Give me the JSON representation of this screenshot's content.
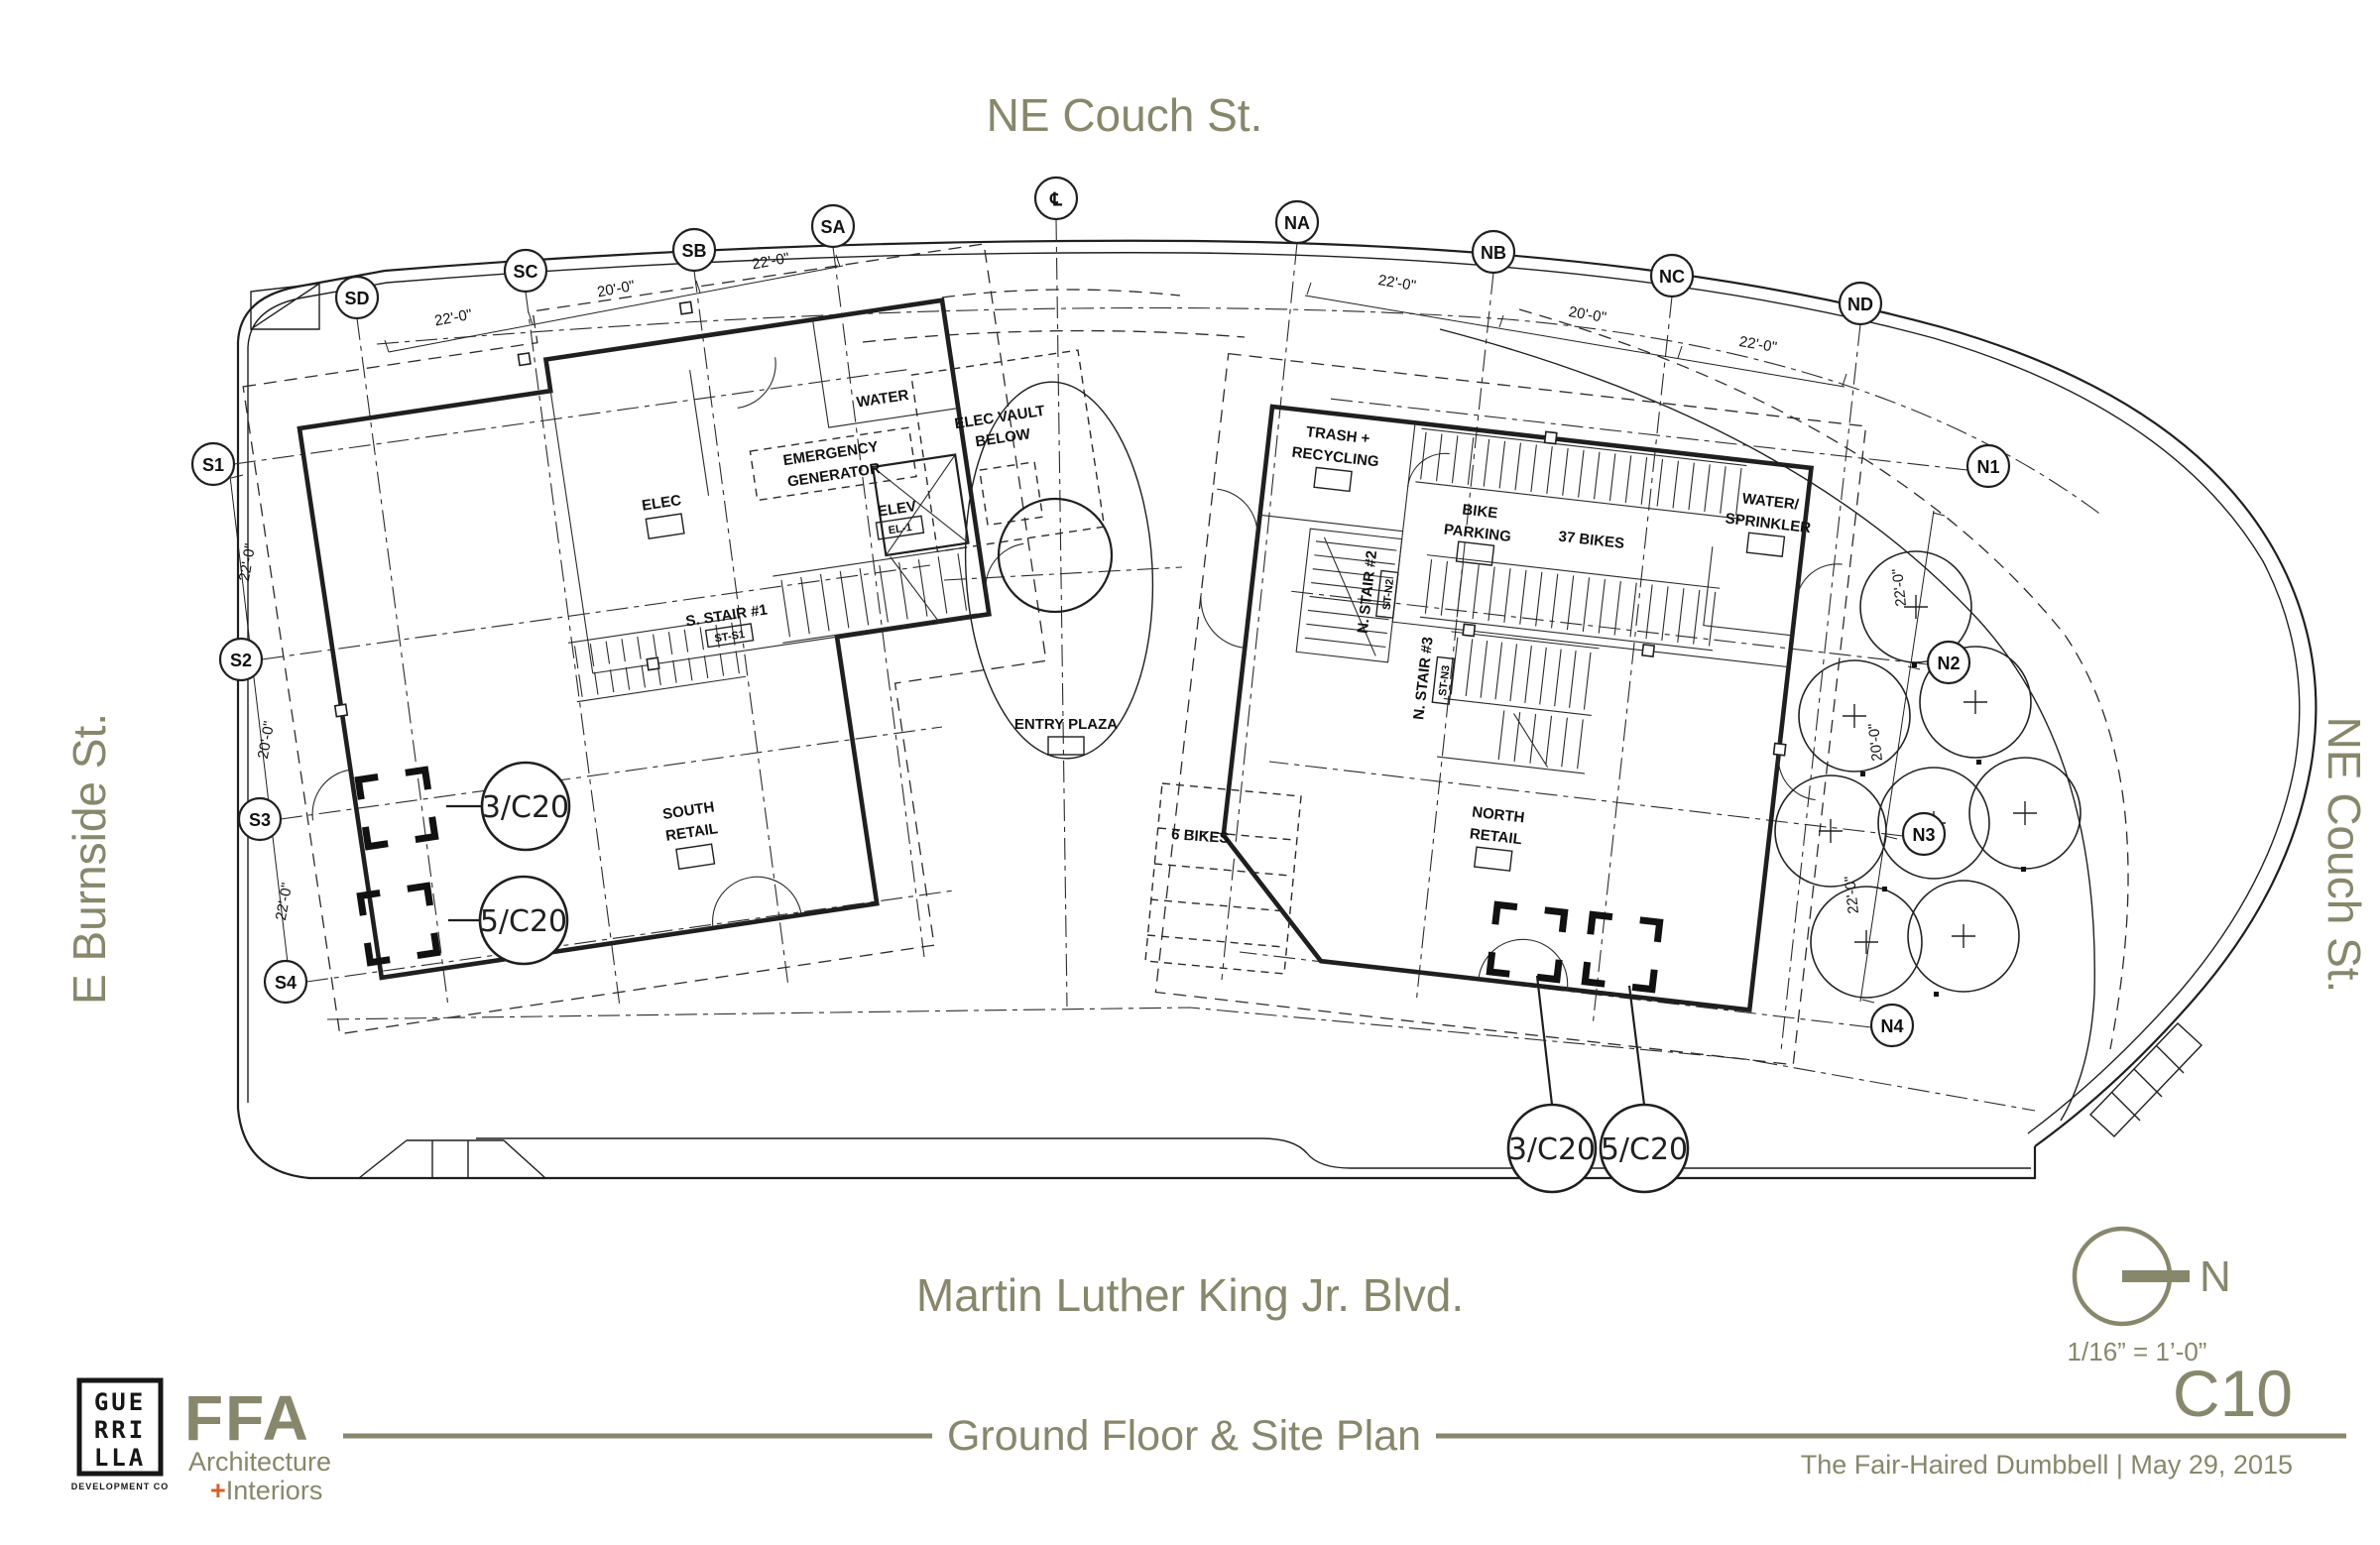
{
  "streets": {
    "top": "NE Couch St.",
    "bottom": "Martin Luther King Jr. Blvd.",
    "left": "E Burnside St.",
    "right": "NE Couch St."
  },
  "grid": {
    "top": [
      "SD",
      "SC",
      "SB",
      "SA",
      "℄",
      "NA",
      "NB",
      "NC",
      "ND"
    ],
    "left": [
      "S1",
      "S2",
      "S3",
      "S4"
    ],
    "right": [
      "N1",
      "N2",
      "N3",
      "N4"
    ]
  },
  "dims": {
    "top_south": [
      "22'-0\"",
      "20'-0\"",
      "22'-0\""
    ],
    "top_north": [
      "22'-0\"",
      "20'-0\"",
      "22'-0\""
    ],
    "west": [
      "22'-0\"",
      "20'-0\"",
      "22'-0\""
    ],
    "east": [
      "22'-0\"",
      "20'-0\"",
      "22'-0\""
    ]
  },
  "labels": {
    "water": "WATER",
    "elec_vault": [
      "ELEC VAULT",
      "BELOW"
    ],
    "emergency": [
      "EMERGENCY",
      "GENERATOR"
    ],
    "elec": "ELEC",
    "elev": "ELEV",
    "elev_tag": "EL-1",
    "s_stair1": "S. STAIR #1",
    "s_stair1_tag": "ST-S1",
    "south_retail": [
      "SOUTH",
      "RETAIL"
    ],
    "trash": [
      "TRASH +",
      "RECYCLING"
    ],
    "bike_parking": [
      "BIKE",
      "PARKING"
    ],
    "bikes37": "37 BIKES",
    "water_sprinkler": [
      "WATER/",
      "SPRINKLER"
    ],
    "n_stair2": "N. STAIR #2",
    "n_stair2_tag": "ST-N2",
    "n_stair3": "N. STAIR #3",
    "n_stair3_tag": "ST-N3",
    "north_retail": [
      "NORTH",
      "RETAIL"
    ],
    "entry_plaza": "ENTRY PLAZA",
    "bikes6": "6 BIKES"
  },
  "callouts": {
    "left_upper": "3/C20",
    "left_lower": "5/C20",
    "bottom_left": "3/C20",
    "bottom_right": "5/C20"
  },
  "north_arrow": {
    "n": "N",
    "scale": "1/16” = 1’-0”"
  },
  "titleblock": {
    "title": "Ground Floor & Site Plan",
    "sheet": "C10",
    "project": "The Fair-Haired Dumbbell | May 29, 2015",
    "guerrilla": [
      "GUE",
      "RRI",
      "LLA"
    ],
    "guerrilla_sub": "DEVELOPMENT CO",
    "ffa": "FFA",
    "ffa_sub1": "Architecture",
    "ffa_plus": "+",
    "ffa_sub2": "Interiors"
  },
  "colors": {
    "accent": "#87876c",
    "plus_orange": "#d4622a",
    "line": "#1f1f1f"
  }
}
